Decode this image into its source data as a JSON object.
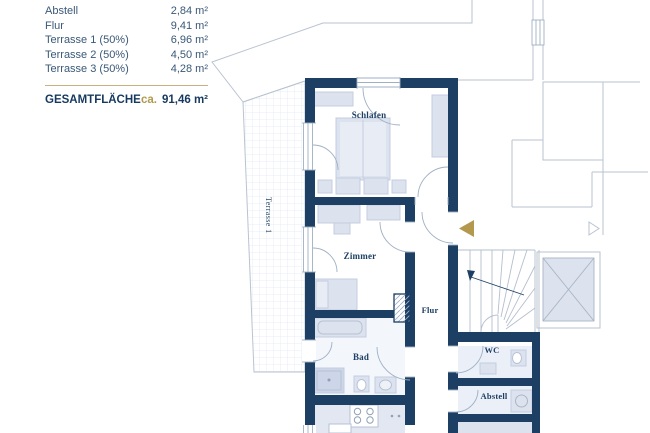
{
  "legend": {
    "rows": [
      {
        "label": "Abstell",
        "value": "2,84 m²"
      },
      {
        "label": "Flur",
        "value": "9,41 m²"
      },
      {
        "label": "Terrasse 1 (50%)",
        "value": "6,96 m²"
      },
      {
        "label": "Terrasse 2 (50%)",
        "value": "4,50 m²"
      },
      {
        "label": "Terrasse 3 (50%)",
        "value": "4,28 m²"
      }
    ],
    "total_label": "GESAMTFLÄCHE",
    "total_prefix": "ca.",
    "total_value": "91,46 m²"
  },
  "plan": {
    "rooms": {
      "schlafen": "Schlafen",
      "zimmer": "Zimmer",
      "flur": "Flur",
      "bad": "Bad",
      "wc": "WC",
      "abstell": "Abstell",
      "terrasse1": "Terrasse 1"
    }
  },
  "colors": {
    "wall": "#1d3f63",
    "accent_gold": "#b3984e",
    "furniture": "#dde3ee",
    "legend_text": "#3a5878"
  }
}
